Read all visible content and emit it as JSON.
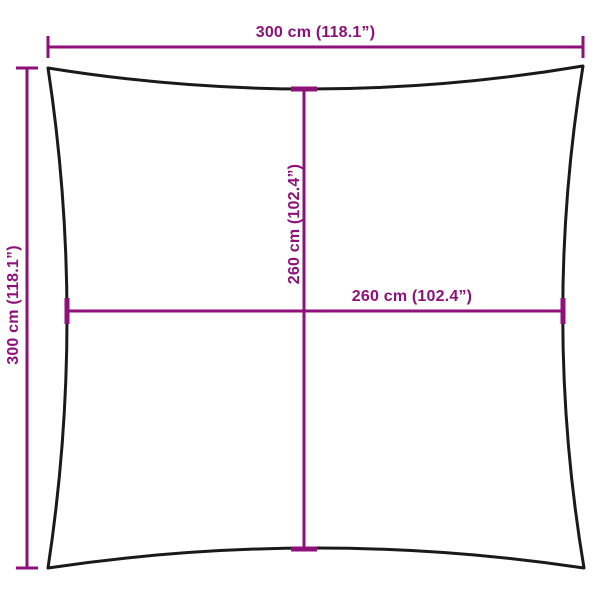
{
  "diagram": {
    "kind": "product-dimension-diagram",
    "subject": "square fabric / shade sail outline",
    "labels": {
      "outer_width": "300 cm (118.1”)",
      "outer_height": "300 cm (118.1”)",
      "inner_width": "260 cm (102.4”)",
      "inner_height": "260 cm (102.4”)"
    },
    "measurements": {
      "outer_width_cm": 300,
      "outer_width_in": 118.1,
      "outer_height_cm": 300,
      "outer_height_in": 118.1,
      "inner_width_cm": 260,
      "inner_width_in": 102.4,
      "inner_height_cm": 260,
      "inner_height_in": 102.4
    },
    "colors": {
      "dimension": "#8E1179",
      "outline": "#1a1a1a",
      "background": "#ffffff"
    }
  }
}
